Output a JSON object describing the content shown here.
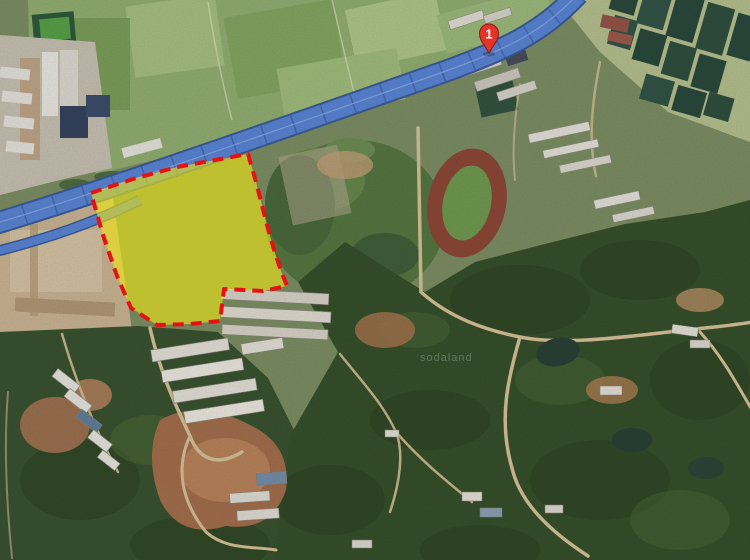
{
  "map": {
    "marker": {
      "label": "1"
    },
    "watermark_text": "sodaland",
    "parcel": {
      "points": "91,193 133,179 177,167 248,154 256,182 267,225 275,253 281,271 287,286 263,291 224,289 220,321 190,324 157,325 131,308 117,276 103,235",
      "fill_opacity": "0.6",
      "dash": "11 7"
    },
    "highway": {
      "main_path": "M -6 224 C 120 186, 300 122, 432 76 C 510 49, 543 31, 578 -6",
      "ramp_path": "M -6 252 C 50 238, 95 222, 140 200"
    }
  },
  "palette": {
    "overlay_fill": "#f2e912",
    "overlay_stroke": "#e81111",
    "road_fill": "#5b87d8",
    "road_casing": "#3c5e9c",
    "marker_fill": "#e2342a",
    "marker_stroke": "#8e1710",
    "track_ring": "#8f4938",
    "track_infield": "#719c52"
  }
}
